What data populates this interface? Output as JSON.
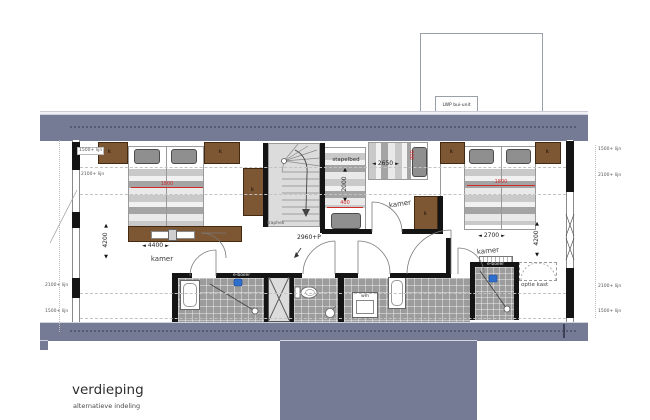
{
  "icons": {
    "arrow_left": "◄",
    "arrow_right": "►",
    "arrow_up": "▲",
    "arrow_down": "▼"
  },
  "title": {
    "main": "verdieping",
    "sub": "alternatieve indeling"
  },
  "exterior": {
    "lwp": "LWP bui-unit"
  },
  "labels": {
    "k": "k"
  },
  "corridor": {
    "level": "2960+P",
    "stair_rail": "traphek"
  },
  "bath": {
    "wm": "wm",
    "eboiler": "e-boiler",
    "optie": "optie kast"
  },
  "height_lines": {
    "left_top": [
      "1500+ lijn",
      "2100+ lijn"
    ],
    "left_bottom": [
      "2100+ lijn",
      "1500+ lijn"
    ],
    "right_top": [
      "1500+ lijn",
      "2100+ lijn"
    ],
    "right_bottom": [
      "2100+ lijn",
      "1500+ lijn"
    ]
  },
  "rooms": {
    "left": {
      "label": "kamer",
      "width_dim": "4400",
      "height_dim": "4200",
      "red_dim": "1800"
    },
    "middle": {
      "label": "kamer",
      "bunk_label": "stapelbed",
      "bunk_dim": "2000",
      "bunk_red": "400",
      "bed_dim": "2650",
      "bed_red": "900"
    },
    "right": {
      "label": "kamer",
      "width_dim": "2700",
      "height_dim": "4200",
      "red_dim": "1800"
    }
  }
}
